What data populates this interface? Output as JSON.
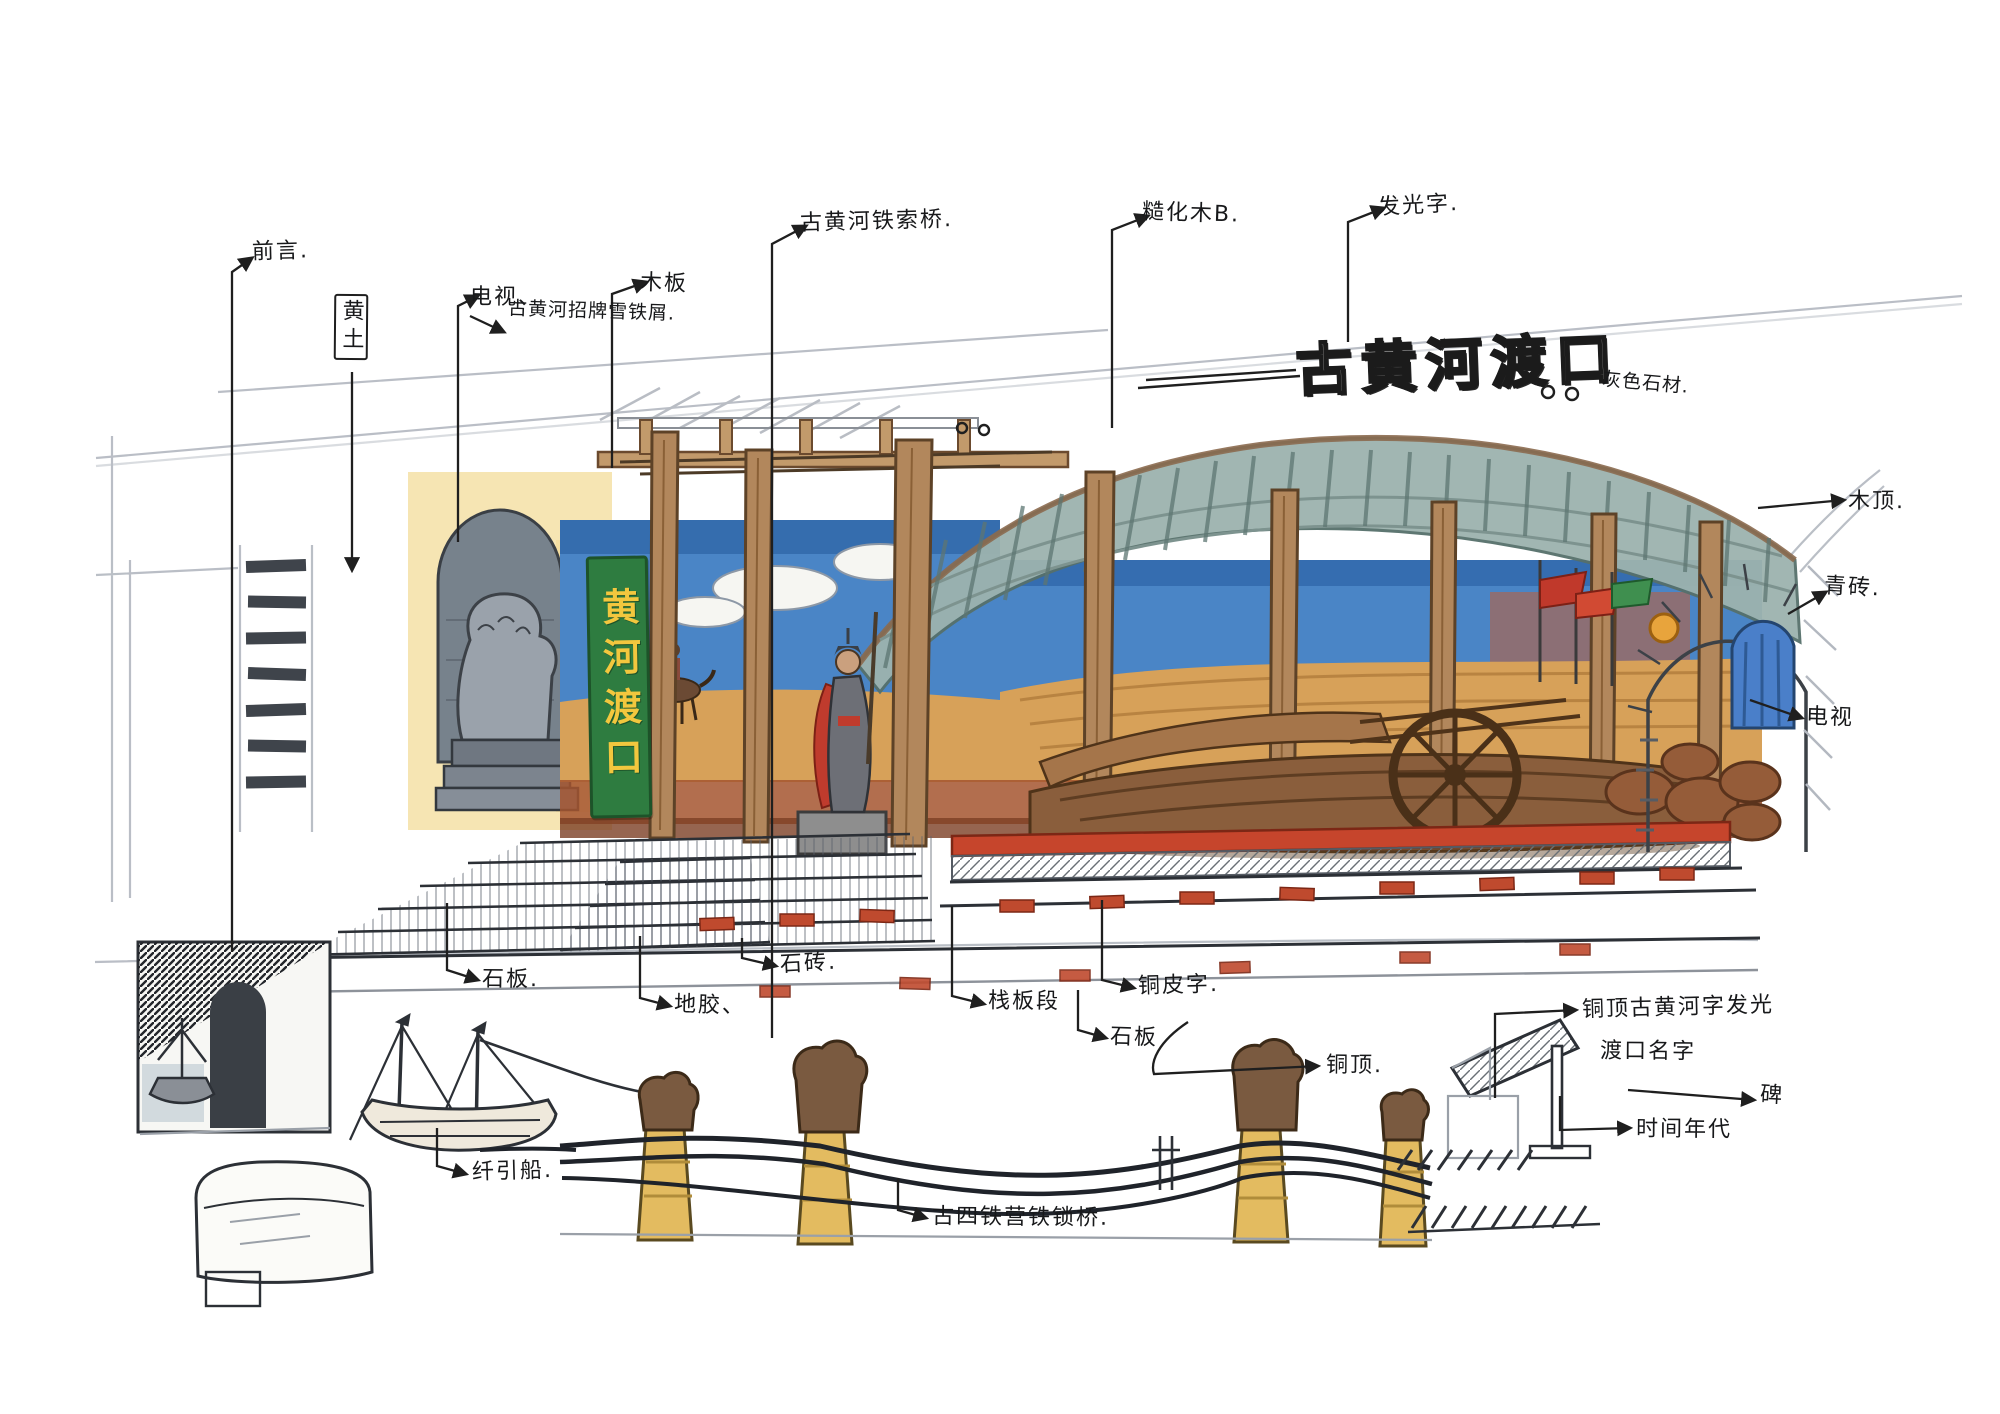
{
  "title": {
    "text": "古黄河渡口",
    "material_note": "灰色石材."
  },
  "sign": {
    "text": "黄河渡口"
  },
  "annotations": {
    "qianyan": "前言.",
    "dianshi_top": "电视、",
    "huangtu": "黄土",
    "muban_top": "木板",
    "zhaopai": "古黄河招牌雪铁屑.",
    "tiesuoqiao": "古黄河铁索桥.",
    "caohuamu": "糙化木B.",
    "faguangzi": "发光字.",
    "muding": "木顶.",
    "qingzhuan": "青砖.",
    "dianshi_right": "电视",
    "shiban_left": "石板.",
    "dijiao": "地胶、",
    "shizhuan": "石砖.",
    "zhanbanduan": "栈板段",
    "tongpizi": "铜皮字.",
    "shiban_mid": "石板",
    "tongding": "铜顶.",
    "tongding_line1": "铜顶古黄河字发光",
    "tongding_line2": "渡口名字",
    "bei": "碑",
    "shijian": "时间年代",
    "qianyinchuan": "纤引船.",
    "guqiao": "古四铁营铁锁桥."
  },
  "colors": {
    "paper": "#ffffff",
    "ink": "#1f1f1f",
    "pencil": "#aab0b8",
    "sign_green": "#2e7c40",
    "sign_yellow": "#f2c73e",
    "sky_blue": "#4a85c6",
    "ochre": "#d7a159",
    "roof_slate": "#9db3ae",
    "wood": "#b2875c",
    "accent_red": "#c6452c"
  }
}
